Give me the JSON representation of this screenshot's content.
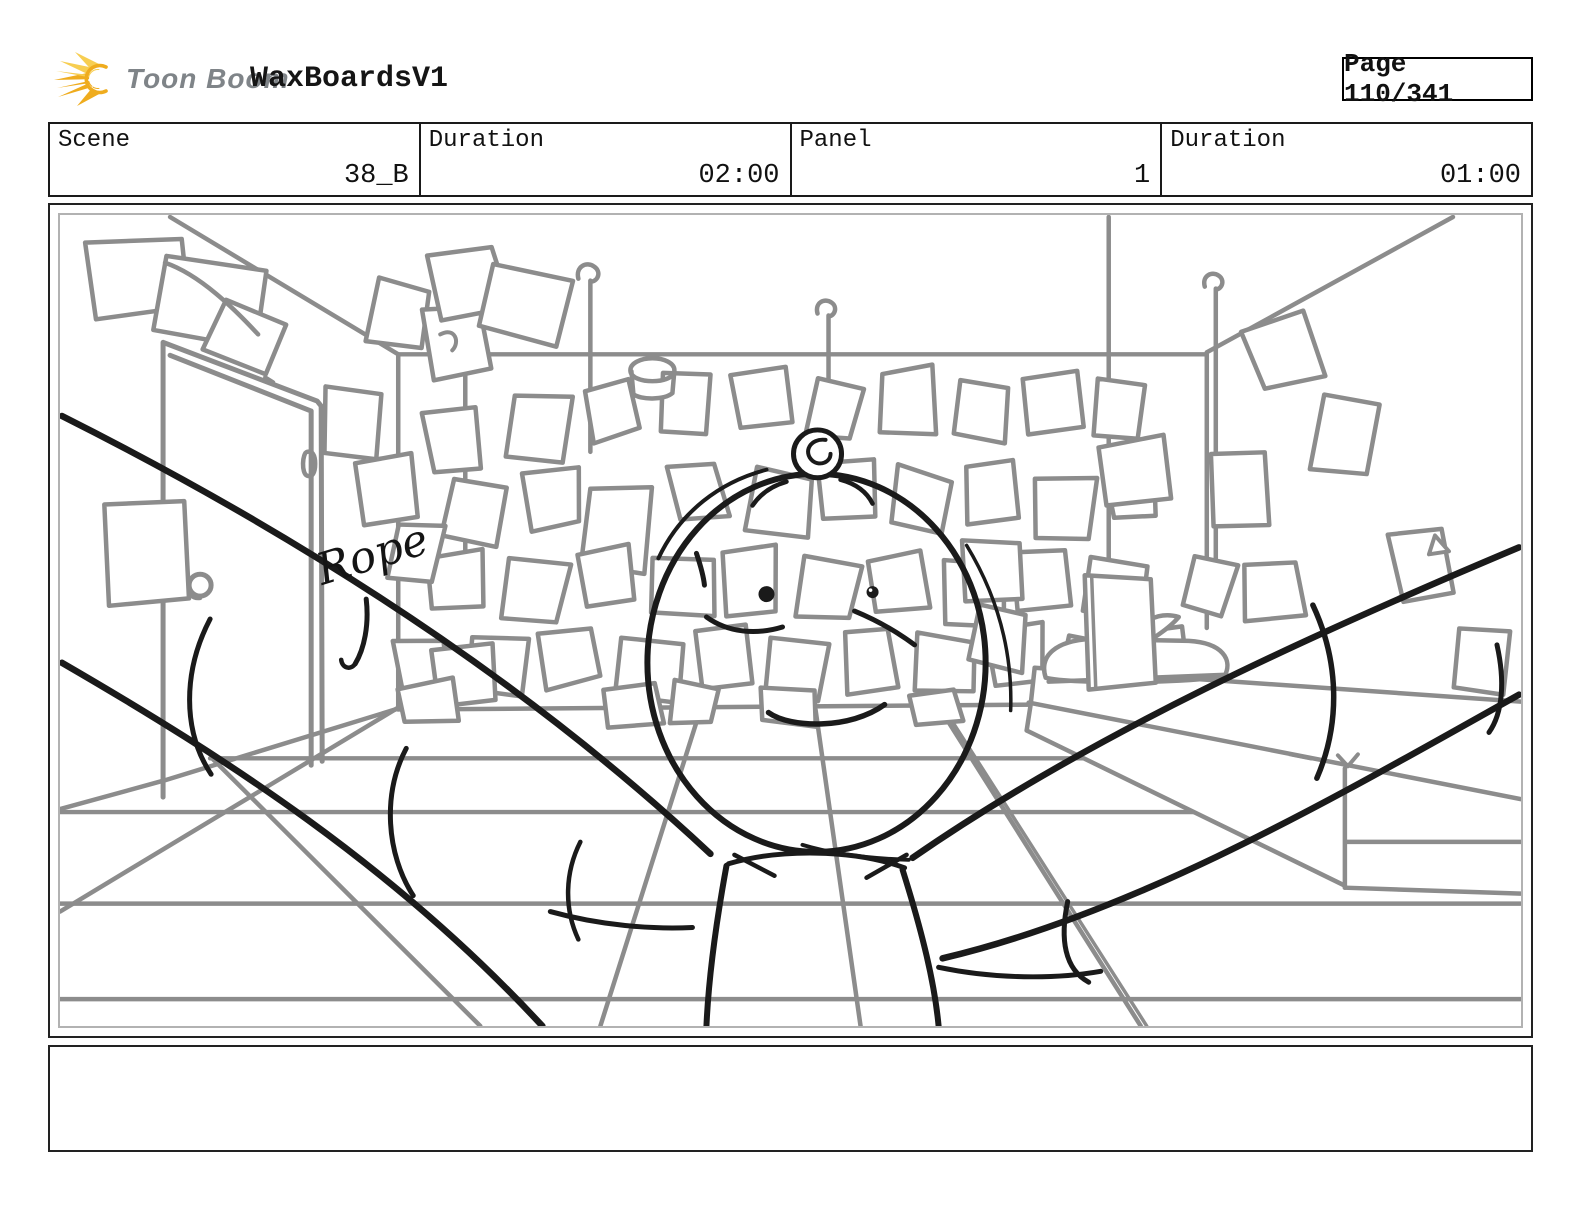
{
  "header": {
    "brand": "Toon Boom",
    "title": "WaxBoardsV1",
    "page": "Page 110/341"
  },
  "info_bar": {
    "cells": [
      {
        "label": "Scene",
        "value": "38_B"
      },
      {
        "label": "Duration",
        "value": "02:00"
      },
      {
        "label": "Panel",
        "value": "1"
      },
      {
        "label": "Duration",
        "value": "01:00"
      }
    ]
  },
  "storyboard_panel": {
    "annotation": "Rope",
    "description": "Sketch: room with sticky notes covering walls, door at left, bed at right, round-headed character facing viewer with arms spread"
  },
  "caption": {
    "text": ""
  },
  "colors": {
    "sketch_gray": "#8c8c8c",
    "ink": "#1a1a1a",
    "logo_yellow": "#EFAC1E",
    "logo_yellow_light": "#F7CE51",
    "logo_text_gray": "#7f8488"
  }
}
